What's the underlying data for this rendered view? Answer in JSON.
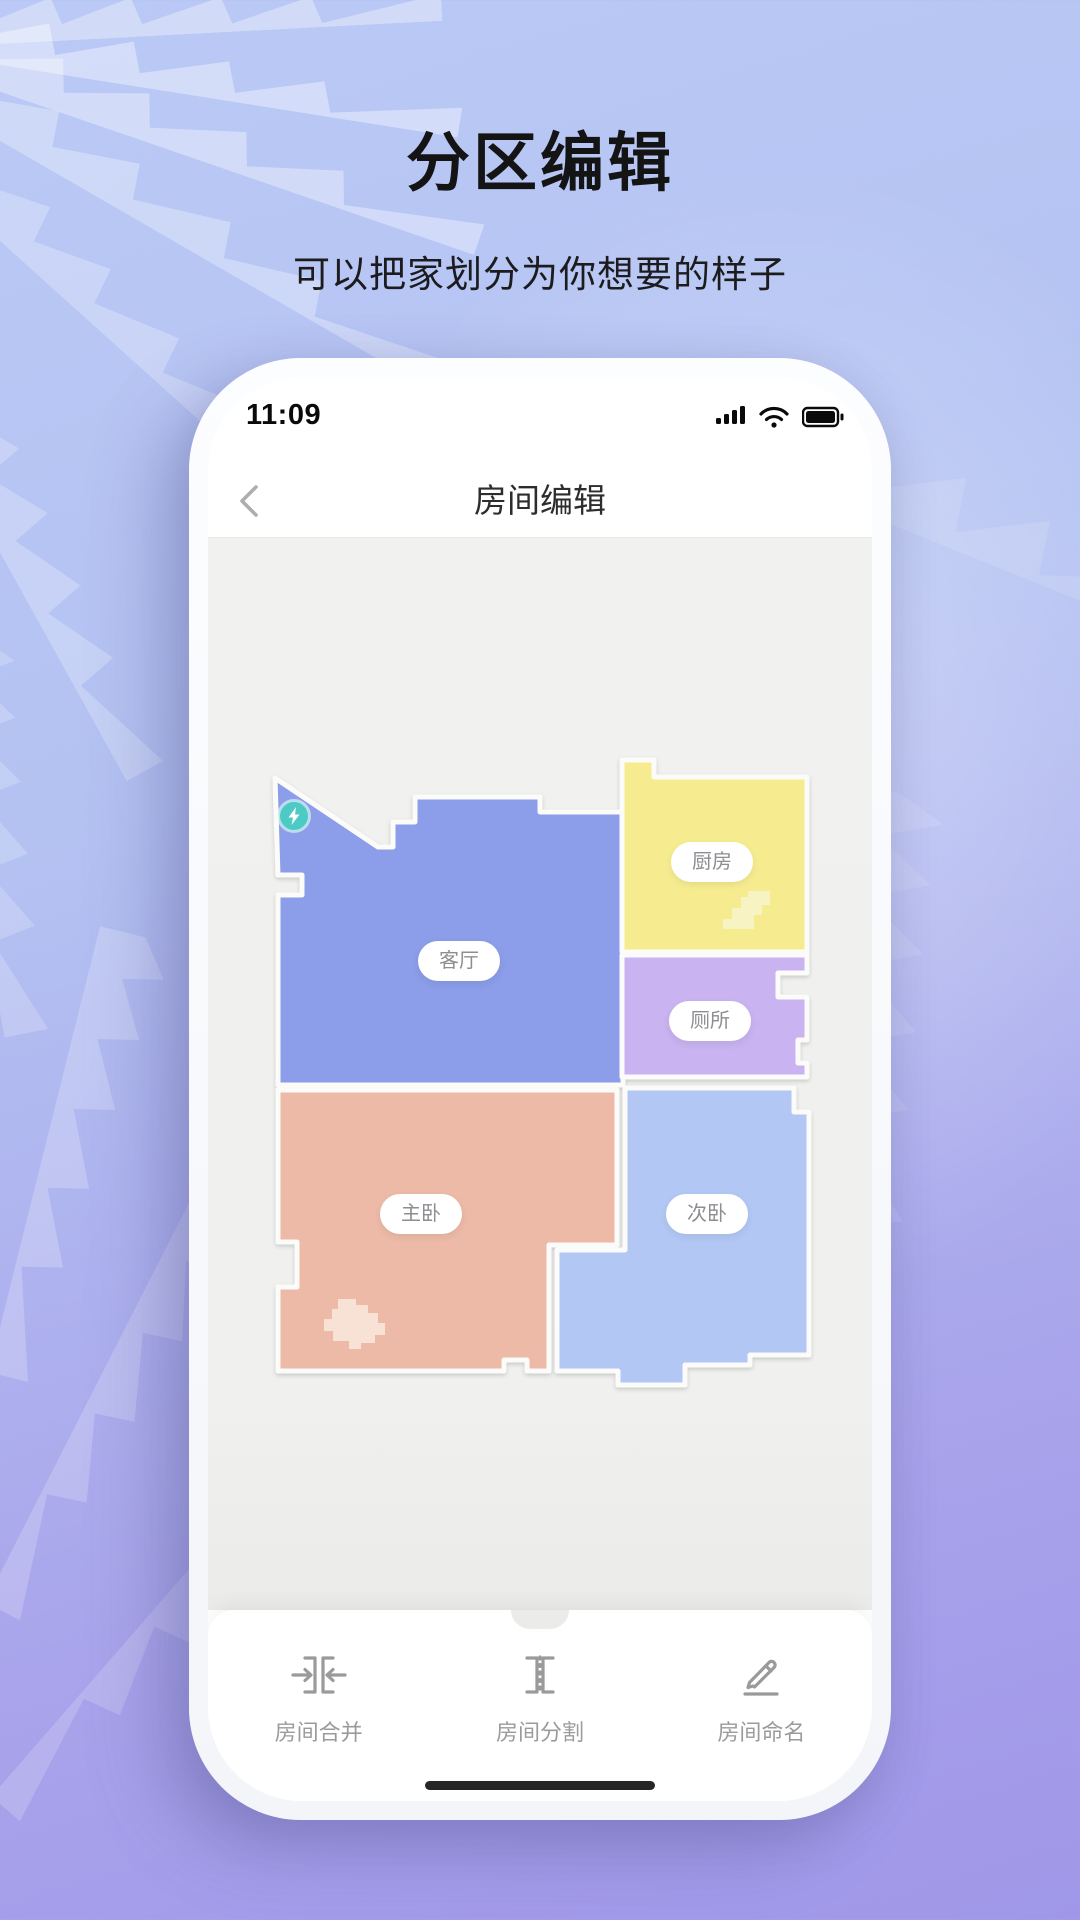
{
  "page": {
    "title": "分区编辑",
    "subtitle": "可以把家划分为你想要的样子"
  },
  "phone": {
    "status_bar": {
      "time": "11:09"
    },
    "nav": {
      "title": "房间编辑"
    },
    "map": {
      "rooms": [
        {
          "id": "living-room",
          "label": "客厅",
          "color": "#8C9DE9"
        },
        {
          "id": "kitchen",
          "label": "厨房",
          "color": "#F6EC8F"
        },
        {
          "id": "toilet",
          "label": "厕所",
          "color": "#C9B3F0"
        },
        {
          "id": "master-bedroom",
          "label": "主卧",
          "color": "#ECBAA7"
        },
        {
          "id": "second-bedroom",
          "label": "次卧",
          "color": "#B3C7F4"
        }
      ],
      "obstacles": {
        "kitchen_color": "#F8F3C2",
        "master_color": "#F8E2D6"
      },
      "charger": {
        "color": "#4ECAC6"
      },
      "wall_color": "#FBFBF9"
    },
    "toolbar": {
      "items": [
        {
          "label": "房间合并"
        },
        {
          "label": "房间分割"
        },
        {
          "label": "房间命名"
        }
      ]
    }
  }
}
